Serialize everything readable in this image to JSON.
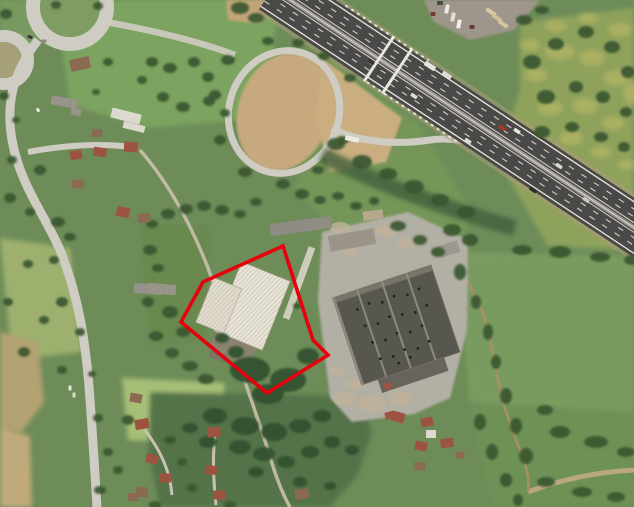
{
  "image": {
    "kind": "satellite aerial photograph",
    "subject": "industrial parcel with white-roofed warehouse outlined by red boundary polygon, beside a motorway interchange"
  },
  "annotation": {
    "name": "parcel-boundary",
    "points": "283,246 313,340 328,355 267,393 181,322 203,282",
    "stroke_width": 3.6
  },
  "colors": {
    "annotation_red": "#e7000e",
    "field_base": "#6d8c58",
    "asphalt": "#4a4947",
    "road": "#cfccc3",
    "concrete": "#b2afa5",
    "warehouse_roof": "#57564f",
    "building_white": "#e9e5d8",
    "tree_green": "#3a5732",
    "shrub_green": "#33512e",
    "dry_grass": "#c6a97c",
    "dry_yellow": "#b4b464",
    "roof_red": "#9c5340",
    "roof_brown": "#8a6a52",
    "roof_gray": "#98948a",
    "roof_light": "#dcd9cf"
  },
  "scene": {
    "trees": [
      [
        6,
        14,
        6,
        5
      ],
      [
        98,
        6,
        5,
        4
      ],
      [
        56,
        5,
        5,
        4
      ],
      [
        108,
        62,
        5,
        4
      ],
      [
        96,
        92,
        4,
        3
      ],
      [
        4,
        96,
        5,
        4
      ],
      [
        16,
        120,
        4,
        3
      ],
      [
        152,
        62,
        6,
        5
      ],
      [
        170,
        68,
        7,
        5
      ],
      [
        194,
        62,
        6,
        5
      ],
      [
        208,
        77,
        6,
        5
      ],
      [
        163,
        97,
        6,
        5
      ],
      [
        183,
        107,
        7,
        5
      ],
      [
        209,
        101,
        6,
        5
      ],
      [
        225,
        113,
        5,
        4
      ],
      [
        142,
        80,
        5,
        4
      ],
      [
        12,
        160,
        5,
        4
      ],
      [
        40,
        170,
        6,
        5
      ],
      [
        58,
        222,
        7,
        5
      ],
      [
        30,
        212,
        5,
        4
      ],
      [
        10,
        198,
        6,
        5
      ],
      [
        70,
        237,
        6,
        4
      ],
      [
        54,
        260,
        5,
        4
      ],
      [
        28,
        264,
        5,
        4
      ],
      [
        62,
        302,
        6,
        5
      ],
      [
        44,
        320,
        5,
        4
      ],
      [
        80,
        332,
        5,
        4
      ],
      [
        62,
        370,
        5,
        4
      ],
      [
        92,
        374,
        4,
        3
      ],
      [
        24,
        352,
        6,
        5
      ],
      [
        8,
        302,
        5,
        4
      ],
      [
        98,
        418,
        5,
        4
      ],
      [
        108,
        452,
        5,
        4
      ],
      [
        100,
        490,
        6,
        4
      ],
      [
        118,
        470,
        5,
        4
      ],
      [
        152,
        224,
        6,
        4
      ],
      [
        168,
        214,
        7,
        5
      ],
      [
        186,
        209,
        7,
        5
      ],
      [
        204,
        206,
        7,
        5
      ],
      [
        222,
        210,
        7,
        5
      ],
      [
        240,
        214,
        6,
        4
      ],
      [
        256,
        202,
        6,
        4
      ],
      [
        150,
        250,
        7,
        5
      ],
      [
        158,
        268,
        6,
        4
      ],
      [
        148,
        302,
        6,
        5
      ],
      [
        156,
        336,
        7,
        5
      ],
      [
        172,
        353,
        7,
        5
      ],
      [
        190,
        366,
        8,
        5
      ],
      [
        206,
        379,
        8,
        5
      ],
      [
        170,
        312,
        8,
        6
      ],
      [
        183,
        332,
        7,
        5
      ],
      [
        297,
        306,
        4,
        3
      ],
      [
        128,
        420,
        6,
        5
      ],
      [
        170,
        440,
        6,
        4
      ],
      [
        182,
        462,
        5,
        4
      ],
      [
        155,
        505,
        6,
        4
      ],
      [
        230,
        505,
        6,
        4
      ],
      [
        192,
        488,
        5,
        4
      ],
      [
        460,
        272,
        6,
        8
      ],
      [
        476,
        302,
        5,
        7
      ],
      [
        488,
        332,
        5,
        8
      ],
      [
        496,
        362,
        5,
        7
      ],
      [
        506,
        396,
        6,
        8
      ],
      [
        516,
        426,
        6,
        8
      ],
      [
        526,
        456,
        7,
        8
      ],
      [
        560,
        432,
        10,
        6
      ],
      [
        596,
        442,
        12,
        6
      ],
      [
        626,
        452,
        9,
        5
      ],
      [
        546,
        482,
        9,
        5
      ],
      [
        582,
        492,
        10,
        5
      ],
      [
        616,
        497,
        9,
        5
      ],
      [
        480,
        422,
        6,
        8
      ],
      [
        492,
        452,
        6,
        8
      ],
      [
        506,
        480,
        6,
        7
      ],
      [
        518,
        500,
        5,
        6
      ],
      [
        545,
        410,
        8,
        5
      ],
      [
        452,
        230,
        9,
        6
      ],
      [
        470,
        240,
        8,
        6
      ],
      [
        522,
        250,
        10,
        5
      ],
      [
        560,
        252,
        11,
        6
      ],
      [
        600,
        257,
        10,
        5
      ],
      [
        632,
        260,
        8,
        5
      ],
      [
        532,
        62,
        9,
        7
      ],
      [
        556,
        44,
        8,
        6
      ],
      [
        586,
        32,
        8,
        6
      ],
      [
        612,
        47,
        8,
        6
      ],
      [
        628,
        72,
        7,
        6
      ],
      [
        546,
        97,
        9,
        7
      ],
      [
        576,
        87,
        7,
        6
      ],
      [
        603,
        97,
        7,
        6
      ],
      [
        626,
        112,
        6,
        5
      ],
      [
        542,
        132,
        8,
        6
      ],
      [
        572,
        127,
        7,
        5
      ],
      [
        601,
        137,
        7,
        5
      ],
      [
        624,
        147,
        6,
        5
      ],
      [
        524,
        20,
        8,
        5
      ],
      [
        542,
        10,
        7,
        4
      ],
      [
        336,
        144,
        9,
        6
      ],
      [
        362,
        162,
        10,
        7
      ],
      [
        388,
        174,
        9,
        6
      ],
      [
        414,
        187,
        10,
        7
      ],
      [
        440,
        200,
        9,
        6
      ],
      [
        466,
        212,
        9,
        6
      ],
      [
        240,
        8,
        9,
        6
      ],
      [
        256,
        18,
        8,
        5
      ],
      [
        302,
        194,
        7,
        5
      ],
      [
        320,
        200,
        6,
        4
      ],
      [
        338,
        196,
        6,
        4
      ],
      [
        356,
        206,
        6,
        4
      ],
      [
        374,
        201,
        5,
        4
      ],
      [
        228,
        60,
        7,
        5
      ],
      [
        215,
        95,
        6,
        5
      ],
      [
        220,
        140,
        6,
        5
      ],
      [
        245,
        172,
        7,
        5
      ],
      [
        283,
        184,
        7,
        5
      ],
      [
        318,
        170,
        6,
        4
      ],
      [
        343,
        140,
        6,
        4
      ],
      [
        350,
        78,
        6,
        4
      ],
      [
        324,
        56,
        6,
        4
      ],
      [
        298,
        43,
        6,
        4
      ],
      [
        268,
        41,
        6,
        4
      ],
      [
        398,
        226,
        8,
        5
      ],
      [
        420,
        240,
        7,
        5
      ],
      [
        438,
        252,
        7,
        5
      ]
    ],
    "shrubs": [
      [
        250,
        370,
        20,
        13
      ],
      [
        288,
        380,
        18,
        12
      ],
      [
        268,
        394,
        16,
        10
      ],
      [
        308,
        356,
        11,
        8
      ],
      [
        236,
        352,
        8,
        6
      ],
      [
        222,
        338,
        7,
        5
      ],
      [
        215,
        416,
        12,
        8
      ],
      [
        245,
        426,
        14,
        9
      ],
      [
        274,
        432,
        13,
        9
      ],
      [
        300,
        426,
        11,
        7
      ],
      [
        322,
        416,
        9,
        6
      ],
      [
        240,
        447,
        11,
        7
      ],
      [
        264,
        454,
        11,
        7
      ],
      [
        208,
        442,
        9,
        6
      ],
      [
        190,
        428,
        8,
        5
      ],
      [
        332,
        442,
        8,
        6
      ],
      [
        352,
        450,
        7,
        5
      ],
      [
        310,
        452,
        9,
        6
      ],
      [
        286,
        462,
        9,
        6
      ],
      [
        256,
        472,
        8,
        5
      ],
      [
        300,
        482,
        7,
        5
      ],
      [
        330,
        486,
        6,
        4
      ]
    ],
    "yellow_patches": [
      [
        560,
        52,
        15,
        8
      ],
      [
        592,
        58,
        13,
        8
      ],
      [
        616,
        78,
        12,
        8
      ],
      [
        550,
        108,
        13,
        7
      ],
      [
        585,
        106,
        13,
        8
      ],
      [
        613,
        123,
        11,
        7
      ],
      [
        632,
        93,
        9,
        11
      ],
      [
        571,
        138,
        12,
        7
      ],
      [
        601,
        152,
        10,
        6
      ],
      [
        556,
        26,
        11,
        6
      ],
      [
        588,
        18,
        10,
        5
      ],
      [
        620,
        30,
        12,
        7
      ],
      [
        536,
        75,
        11,
        7
      ],
      [
        627,
        165,
        9,
        5
      ],
      [
        530,
        45,
        10,
        6
      ]
    ],
    "rubble": [
      [
        340,
        228,
        10,
        6
      ],
      [
        362,
        240,
        12,
        7
      ],
      [
        386,
        231,
        10,
        6
      ],
      [
        406,
        243,
        9,
        6
      ],
      [
        350,
        251,
        8,
        5
      ],
      [
        345,
        399,
        12,
        7
      ],
      [
        372,
        404,
        14,
        8
      ],
      [
        401,
        399,
        12,
        7
      ],
      [
        354,
        384,
        8,
        5
      ],
      [
        391,
        387,
        9,
        5
      ],
      [
        336,
        370,
        7,
        5
      ]
    ],
    "houses": [
      [
        80,
        64,
        20,
        12,
        -12,
        "roof_brown"
      ],
      [
        64,
        102,
        26,
        9,
        10,
        "roof_gray"
      ],
      [
        76,
        112,
        10,
        7,
        10,
        "roof_gray"
      ],
      [
        126,
        116,
        30,
        10,
        14,
        "roof_light"
      ],
      [
        134,
        127,
        22,
        7,
        14,
        "roof_light"
      ],
      [
        97,
        133,
        10,
        8,
        0,
        "roof_brown"
      ],
      [
        76,
        155,
        12,
        9,
        -8,
        "roof_red"
      ],
      [
        100,
        152,
        13,
        9,
        8,
        "roof_red"
      ],
      [
        131,
        147,
        14,
        10,
        5,
        "roof_red"
      ],
      [
        78,
        184,
        12,
        9,
        0,
        "roof_brown"
      ],
      [
        123,
        212,
        13,
        10,
        10,
        "roof_red"
      ],
      [
        144,
        218,
        12,
        9,
        -5,
        "roof_brown"
      ],
      [
        162,
        289,
        28,
        10,
        5,
        "roof_gray"
      ],
      [
        142,
        424,
        14,
        10,
        -10,
        "roof_red"
      ],
      [
        152,
        459,
        12,
        9,
        15,
        "roof_red"
      ],
      [
        165,
        478,
        12,
        9,
        0,
        "roof_red"
      ],
      [
        142,
        492,
        12,
        10,
        5,
        "roof_brown"
      ],
      [
        214,
        432,
        13,
        10,
        -5,
        "roof_red"
      ],
      [
        211,
        470,
        12,
        9,
        5,
        "roof_red"
      ],
      [
        219,
        495,
        12,
        9,
        0,
        "roof_red"
      ],
      [
        302,
        494,
        14,
        10,
        -10,
        "roof_brown"
      ],
      [
        398,
        417,
        13,
        10,
        15,
        "roof_red"
      ],
      [
        427,
        422,
        12,
        9,
        -10,
        "roof_red"
      ],
      [
        431,
        434,
        10,
        8,
        0,
        "roof_light"
      ],
      [
        421,
        446,
        12,
        9,
        10,
        "roof_red"
      ],
      [
        447,
        443,
        13,
        9,
        -8,
        "roof_red"
      ],
      [
        420,
        466,
        11,
        8,
        5,
        "roof_brown"
      ],
      [
        460,
        455,
        9,
        7,
        0,
        "roof_brown"
      ],
      [
        136,
        398,
        12,
        9,
        10,
        "roof_brown"
      ],
      [
        133,
        497,
        10,
        8,
        0,
        "roof_brown"
      ],
      [
        390,
        415,
        10,
        7,
        -15,
        "roof_red"
      ],
      [
        388,
        386,
        8,
        6,
        -18,
        "roof_red"
      ]
    ],
    "vehicles": [
      [
        447,
        9,
        4,
        9,
        12,
        "#eceae4"
      ],
      [
        453,
        17,
        4,
        9,
        12,
        "#e2dfd7"
      ],
      [
        459,
        24,
        4,
        9,
        12,
        "#f1efe9"
      ],
      [
        433,
        14,
        5,
        4,
        0,
        "#7a3b2f"
      ],
      [
        472,
        27,
        5,
        4,
        0,
        "#6b3a30"
      ],
      [
        440,
        3,
        6,
        4,
        0,
        "#4a4a45"
      ],
      [
        491,
        12,
        11,
        4,
        35,
        "#d8c9a0"
      ],
      [
        497,
        18,
        11,
        4,
        35,
        "#cfc29a"
      ],
      [
        503,
        24,
        11,
        4,
        35,
        "#d6c69e"
      ],
      [
        371,
        62,
        7,
        3.5,
        33,
        "#35352f"
      ],
      [
        414,
        96,
        7,
        3.5,
        33,
        "#dddcd6"
      ],
      [
        502,
        128,
        7,
        3.5,
        33,
        "#b63428"
      ],
      [
        517,
        131,
        7,
        3.5,
        33,
        "#e9e9e5"
      ],
      [
        559,
        166,
        7,
        3.5,
        33,
        "#dcdbd5"
      ],
      [
        533,
        190,
        8,
        3.5,
        33,
        "#2e2e2a"
      ],
      [
        468,
        141,
        7,
        3.5,
        33,
        "#d8d8d2"
      ],
      [
        586,
        200,
        7,
        3.5,
        33,
        "#c8c7c1"
      ],
      [
        352,
        139,
        14,
        5,
        12,
        "#eceae4"
      ],
      [
        430,
        66,
        12,
        5,
        33,
        "#e6e4de"
      ],
      [
        447,
        75,
        10,
        4,
        33,
        "#dcd9d0"
      ],
      [
        30,
        37,
        5,
        3,
        20,
        "#3a3a36"
      ],
      [
        44,
        41,
        5,
        3,
        0,
        "#8a8a84"
      ],
      [
        38,
        110,
        4,
        3,
        60,
        "#eae8e2"
      ],
      [
        70,
        388,
        3,
        5,
        0,
        "#e8e6e0"
      ],
      [
        74,
        395,
        3,
        5,
        0,
        "#dddbd3"
      ]
    ],
    "roof_vents": [
      [
        -32,
        -26
      ],
      [
        -19,
        -28
      ],
      [
        -6,
        -25
      ],
      [
        7,
        -27
      ],
      [
        20,
        -24
      ],
      [
        33,
        -26
      ],
      [
        -30,
        -8
      ],
      [
        -17,
        -6
      ],
      [
        -4,
        -9
      ],
      [
        9,
        -7
      ],
      [
        22,
        -5
      ],
      [
        35,
        -8
      ],
      [
        -28,
        10
      ],
      [
        -15,
        12
      ],
      [
        -2,
        9
      ],
      [
        11,
        12
      ],
      [
        24,
        10
      ],
      [
        -26,
        28
      ],
      [
        -13,
        30
      ],
      [
        0,
        27
      ],
      [
        13,
        30
      ],
      [
        26,
        27
      ],
      [
        -10,
        38
      ],
      [
        3,
        36
      ]
    ]
  }
}
